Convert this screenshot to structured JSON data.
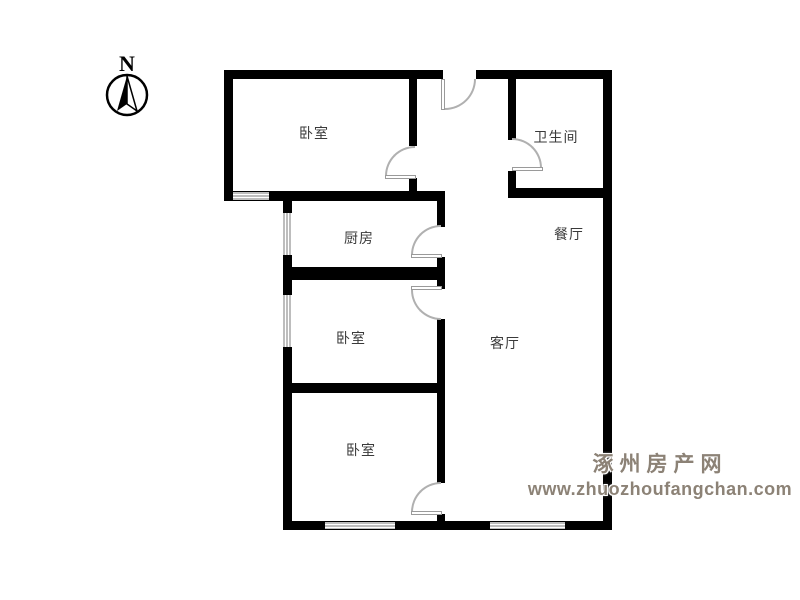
{
  "compass": {
    "label": "N"
  },
  "rooms": [
    {
      "name": "bedroom-top",
      "label": "卧室"
    },
    {
      "name": "bathroom",
      "label": "卫生间"
    },
    {
      "name": "kitchen",
      "label": "厨房"
    },
    {
      "name": "dining-room",
      "label": "餐厅"
    },
    {
      "name": "bedroom-middle",
      "label": "卧室"
    },
    {
      "name": "living-room",
      "label": "客厅"
    },
    {
      "name": "bedroom-bottom",
      "label": "卧室"
    }
  ],
  "watermark": {
    "site_name": "涿州房产网",
    "url": "www.zhuozhoufangchan.com"
  },
  "colors": {
    "wall": "#000000",
    "background": "#ffffff",
    "watermark_text": "#8c8276",
    "door_arc": "#b0b0b0",
    "label_text": "#3a3a3a"
  }
}
